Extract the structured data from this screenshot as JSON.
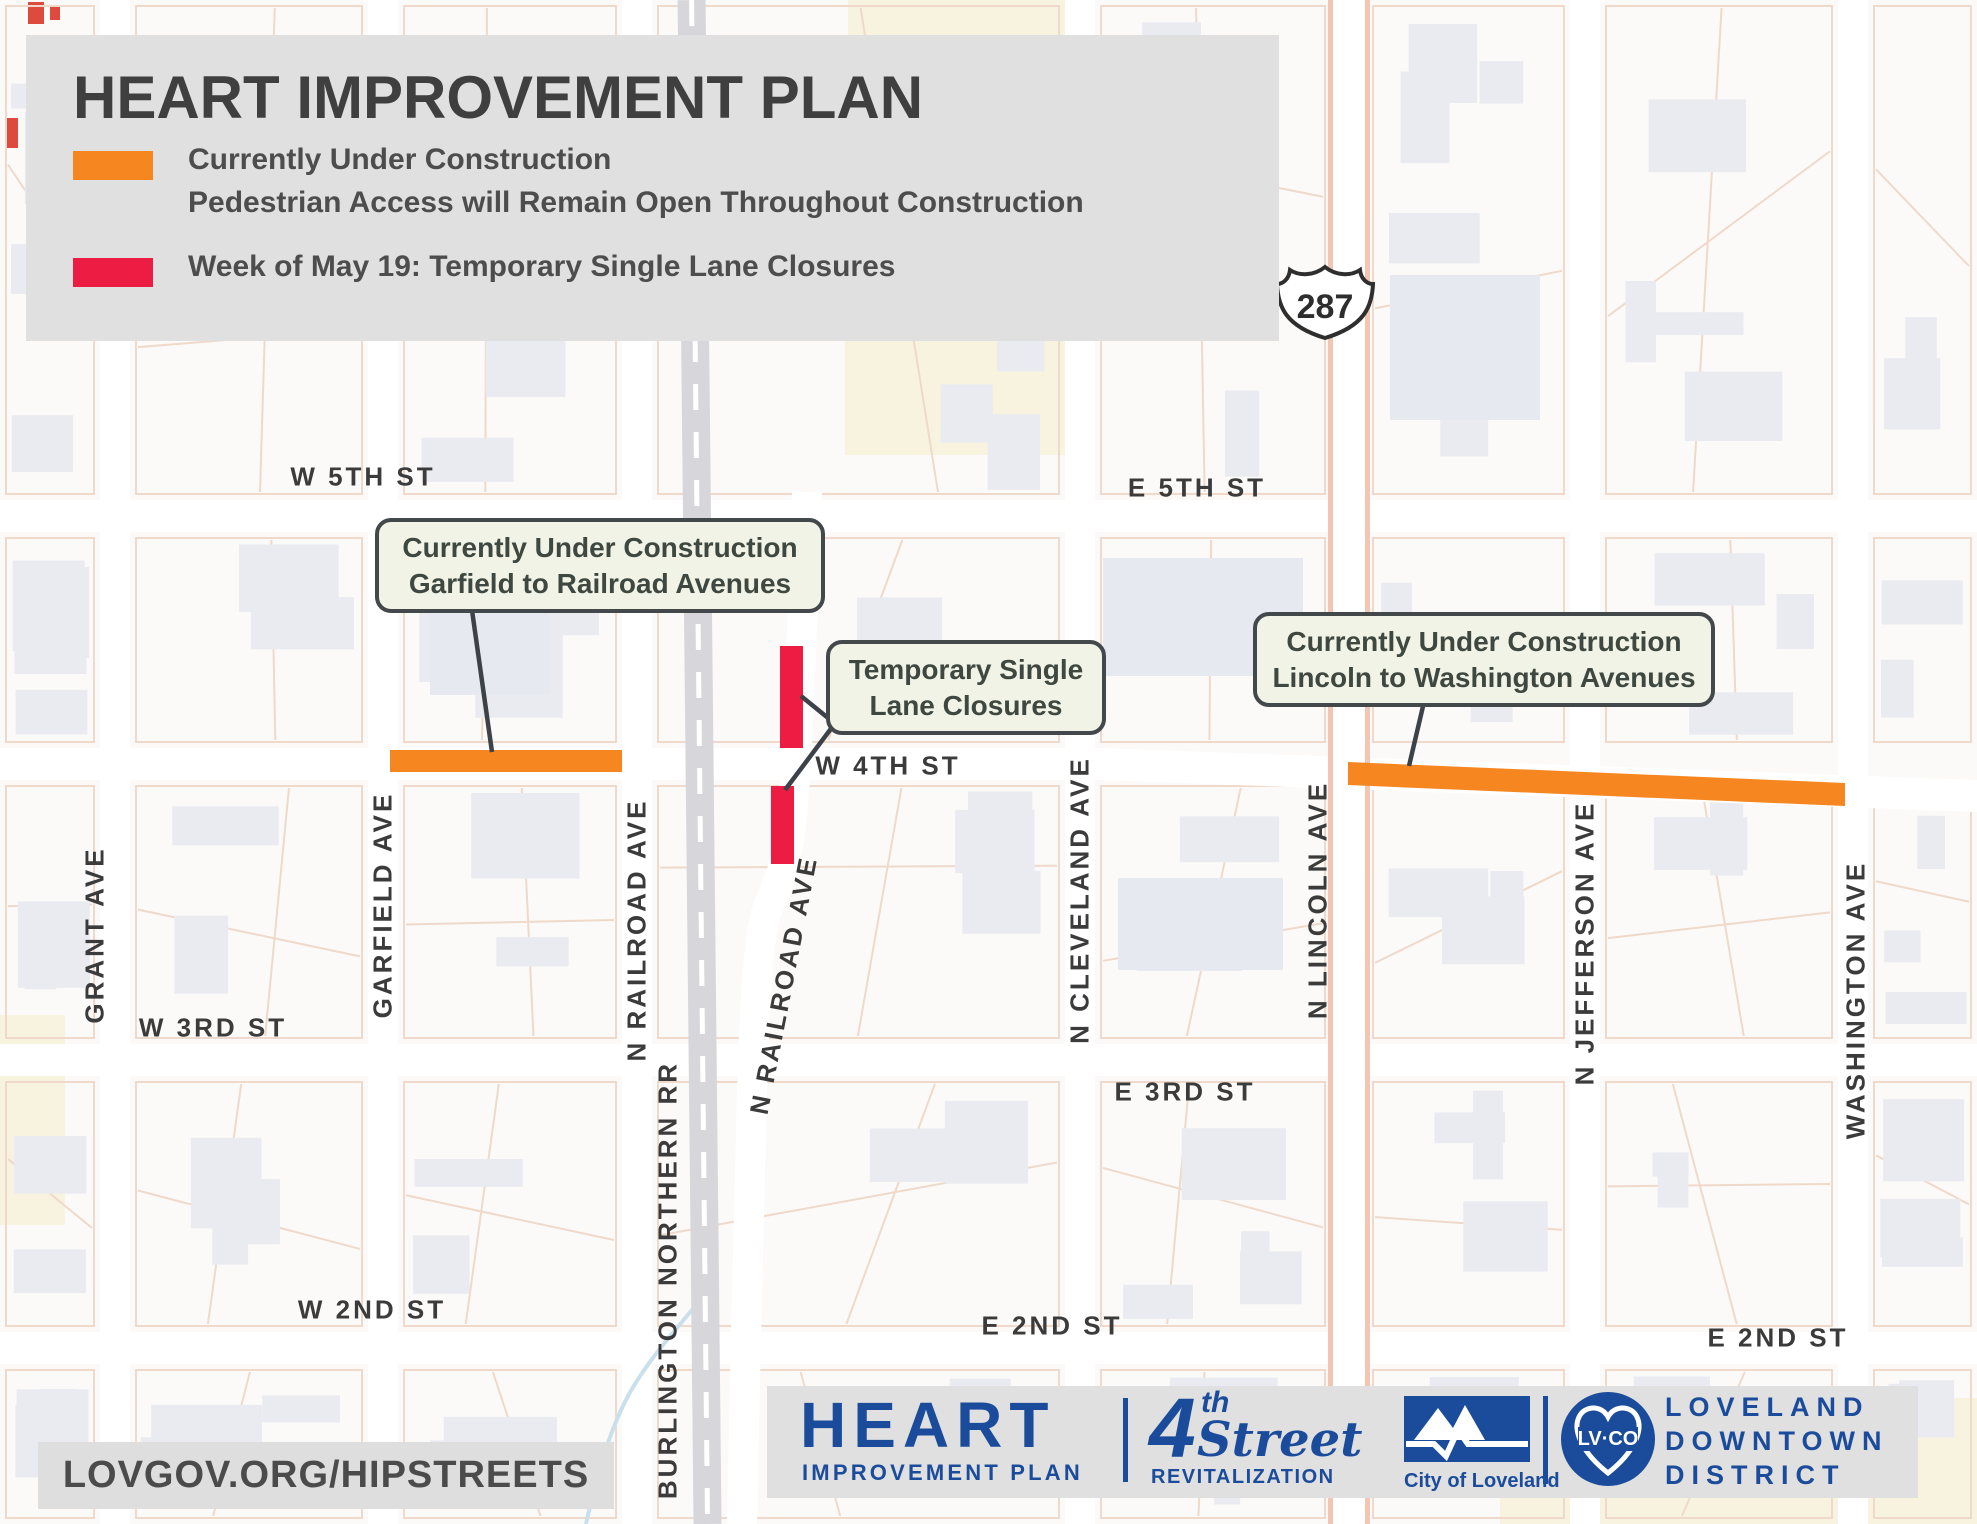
{
  "legend": {
    "title": "HEART IMPROVEMENT PLAN",
    "items": [
      {
        "swatch": "#F6861F",
        "lines": [
          "Currently Under Construction",
          "Pedestrian Access will Remain Open Throughout Construction"
        ]
      },
      {
        "swatch": "#EC1C43",
        "lines": [
          "Week of May 19: Temporary Single Lane Closures"
        ]
      }
    ]
  },
  "map": {
    "shield": "287",
    "labels": {
      "w5th": "W 5TH ST",
      "e5th": "E 5TH ST",
      "w4th": "W 4TH ST",
      "w3rd": "W 3RD ST",
      "e3rd": "E 3RD ST",
      "w2nd": "W 2ND ST",
      "e2nd_mid": "E 2ND ST",
      "e2nd_right": "E 2ND ST",
      "grant": "GRANT AVE",
      "garfield": "GARFIELD AVE",
      "railroad_w": "N RAILROAD AVE",
      "bnrr": "BURLINGTON NORTHERN RR",
      "railroad_e": "N RAILROAD AVE",
      "cleveland": "N CLEVELAND AVE",
      "lincoln": "N LINCOLN AVE",
      "jefferson": "N JEFFERSON AVE",
      "washington": "WASHINGTON AVE"
    },
    "callouts": [
      {
        "lines": [
          "Currently Under Construction",
          "Garfield to Railroad Avenues"
        ]
      },
      {
        "lines": [
          "Temporary Single",
          "Lane Closures"
        ]
      },
      {
        "lines": [
          "Currently Under Construction",
          "Lincoln to Washington Avenues"
        ]
      }
    ]
  },
  "footer": {
    "url": "LOVGOV.ORG/HIPSTREETS",
    "heart_logo": {
      "title": "HEART",
      "subtitle": "IMPROVEMENT PLAN"
    },
    "fourth_logo": {
      "numeral": "4",
      "ordinal": "th",
      "word": "Street",
      "subtitle": "REVITALIZATION"
    },
    "city_logo": {
      "caption": "City of Loveland"
    },
    "district_logo": {
      "badge": "LV·CO",
      "lines": [
        "LOVELAND",
        "DOWNTOWN",
        "DISTRICT"
      ]
    }
  },
  "colors": {
    "construction": "#F6861F",
    "closure": "#EC1C43",
    "navy": "#1B4C9C"
  }
}
